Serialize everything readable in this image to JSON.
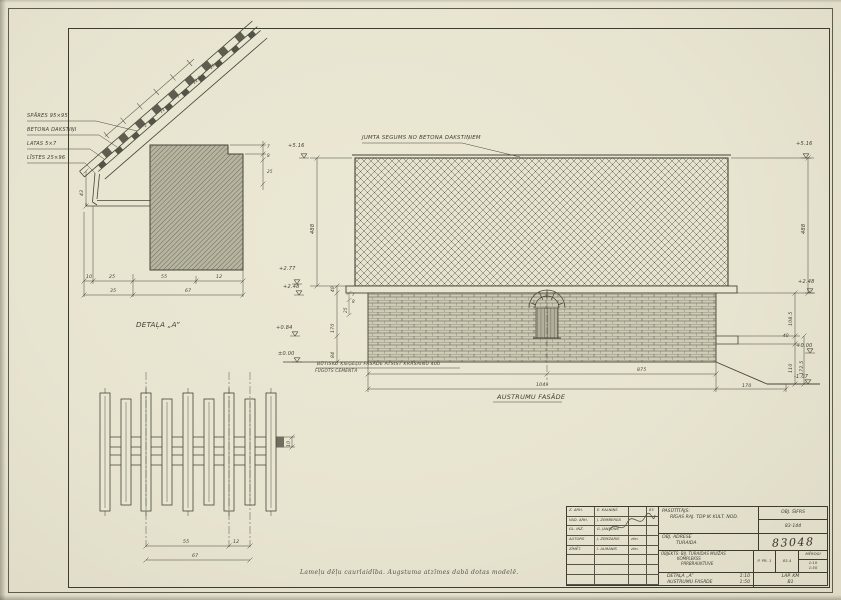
{
  "colors": {
    "paper": "#e8e5d1",
    "line": "#45443a",
    "hatch_fill": "#b7b5a0"
  },
  "detail_a": {
    "caption": "DETAĻA „A”",
    "callouts": [
      {
        "label": "SPĀRES 95×95"
      },
      {
        "label": "BETONA DAKSTIŅI"
      },
      {
        "label": "LATAS 5×7"
      },
      {
        "label": "LĪSTES 25×96"
      }
    ],
    "slope_dims": [
      "2",
      "12",
      "7",
      "12.5",
      "25"
    ],
    "notch_dims": [
      "7",
      "8",
      "25"
    ],
    "gutter_dim": "43",
    "dims_row1": [
      "10",
      "25",
      "55",
      "12"
    ],
    "dims_row2": [
      "35",
      "67"
    ]
  },
  "elevation": {
    "roof_label": "JUMTA SEGUMS NO BETONA DAKSTIŅIEM",
    "facade_note": "BŪTISKU ĶIEĢEĻU FASĀDE ATSIST KRĀSAINU 400",
    "facade_note2": "FŪGOTS CEMENTĀ",
    "title": "AUSTRUMU FASĀDE",
    "marks": {
      "left_ridge": "+5.16",
      "right_ridge": "+5.16",
      "left_fascia_top": "+2.77",
      "left_eave": "+2.48",
      "right_eave": "+2.48",
      "left_ledge": "+0.84",
      "left_ground": "±0.00",
      "right_ground": "+0.00",
      "right_low": "-1.07"
    },
    "dims": {
      "roof_height_left": "488",
      "roof_height_right": "488",
      "fascia": "40",
      "wall_upper": "170",
      "wall_lower": "84",
      "cluster": [
        "7",
        "8",
        "25"
      ],
      "right_upper": "108.5",
      "ledge_t": "40",
      "right_lower": "110",
      "right_total": "172.5",
      "length": "875",
      "total": "1049",
      "ramp": "170"
    }
  },
  "fence": {
    "dim_inner": "55",
    "dim_side": "12",
    "dim_total": "67",
    "rail": "10"
  },
  "footnote": "Lameļu dēļu caurlaidība. Augstuma atzīmes dabā dotas modelē.",
  "title_block": {
    "signatures": [
      {
        "role": "Z. ARH.",
        "name": "E. KALNIŅŠ",
        "sig": "",
        "date": "83"
      },
      {
        "role": "VAD. ARH.",
        "name": "J. ZEMBERGS",
        "sig": "",
        "date": ""
      },
      {
        "role": "GL. INŽ.",
        "name": "G. JANSONS",
        "sig": "",
        "date": ""
      },
      {
        "role": "AUTORS",
        "name": "J. ZEMZARIS",
        "sig": "zīm.",
        "date": ""
      },
      {
        "role": "ZĪMĒT.",
        "name": "I. ALMANIS",
        "sig": "zīm.",
        "date": ""
      }
    ],
    "client_label": "PASŪTĪTĀJS:",
    "client": "RĪGAS RAJ. TDP IK KULT. NOD.",
    "cipher_label": "OBJ. ŠIFRS",
    "cipher": "83-144",
    "address_label": "OBJ. ADRESE",
    "address": "TURAIDA",
    "project_no": "83048",
    "object_lines": [
      "OBJEKTS: BIJ. TURAIDAS MUIŽAS",
      "KOMPLEKSS",
      "PĀRBRAUKTUVE"
    ],
    "stage": "P. PR. 1",
    "code": "83-4",
    "scales_label": "MĒROGI",
    "scales": [
      "1:10",
      "1:50"
    ],
    "items": [
      {
        "label": "DETAĻA „A”",
        "scale": "1:10"
      },
      {
        "label": "AUSTRUMU FASĀDE",
        "scale": "1:50"
      }
    ],
    "sheet_label": "LAP. KM",
    "sheet_no": "B1"
  }
}
